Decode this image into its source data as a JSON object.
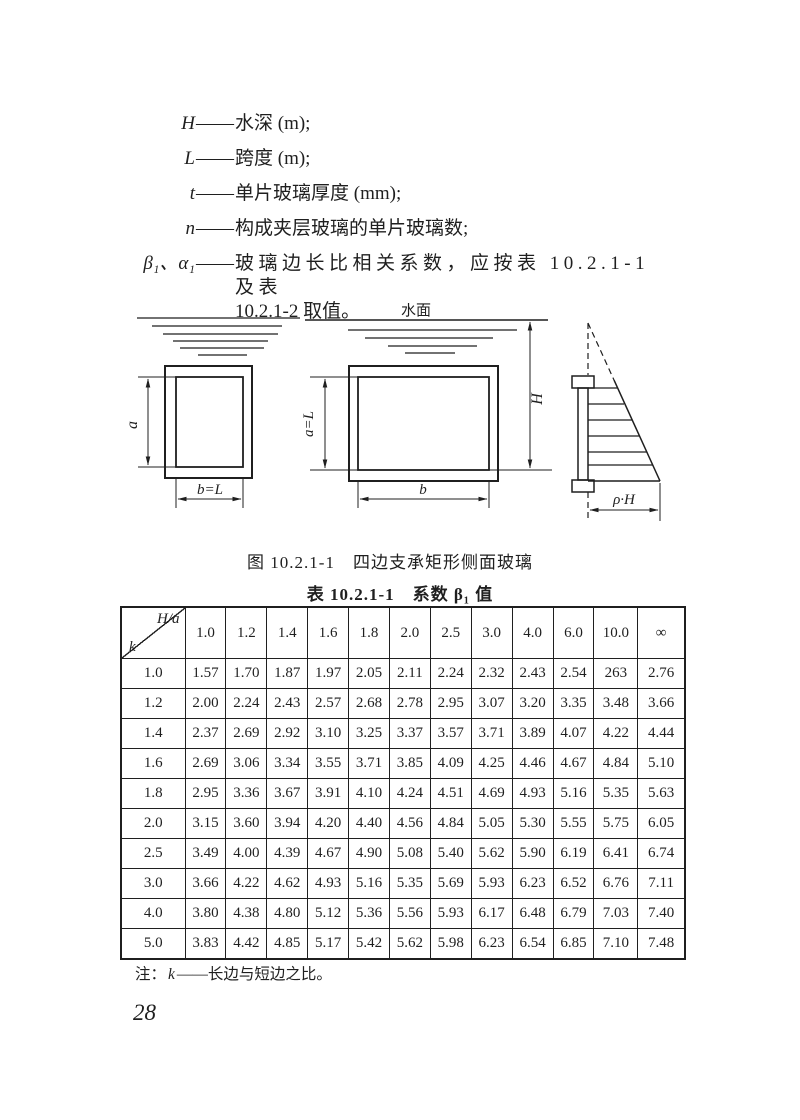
{
  "page": {
    "number": "28",
    "ink": "#1f1f1f",
    "background": "#ffffff"
  },
  "definitions_dash": "——",
  "definitions": [
    {
      "symbol": "H",
      "text": "水深 (m);"
    },
    {
      "symbol": "L",
      "text": "跨度 (m);"
    },
    {
      "symbol": "t",
      "text": "单片玻璃厚度 (mm);"
    },
    {
      "symbol": "n",
      "text": "构成夹层玻璃的单片玻璃数;"
    },
    {
      "symbol": "β₁、α₁",
      "text": "玻璃边长比相关系数，应按表 10.2.1-1 及表",
      "text2": "10.2.1-2 取值。",
      "spread": true
    }
  ],
  "figure": {
    "caption": "图 10.2.1-1　四边支承矩形侧面玻璃",
    "labels": {
      "water_surface": "水面",
      "a": "a",
      "b_eq_L": "b=L",
      "a_eq_L": "a=L",
      "b": "b",
      "H": "H",
      "rho_H": "ρ·H"
    }
  },
  "table": {
    "title": "表 10.2.1-1　系数 β₁ 值",
    "corner_top": "H/a",
    "corner_bottom": "k",
    "columns": [
      "1.0",
      "1.2",
      "1.4",
      "1.6",
      "1.8",
      "2.0",
      "2.5",
      "3.0",
      "4.0",
      "6.0",
      "10.0",
      "∞"
    ],
    "rows": [
      {
        "k": "1.0",
        "values": [
          "1.57",
          "1.70",
          "1.87",
          "1.97",
          "2.05",
          "2.11",
          "2.24",
          "2.32",
          "2.43",
          "2.54",
          "263",
          "2.76"
        ]
      },
      {
        "k": "1.2",
        "values": [
          "2.00",
          "2.24",
          "2.43",
          "2.57",
          "2.68",
          "2.78",
          "2.95",
          "3.07",
          "3.20",
          "3.35",
          "3.48",
          "3.66"
        ]
      },
      {
        "k": "1.4",
        "values": [
          "2.37",
          "2.69",
          "2.92",
          "3.10",
          "3.25",
          "3.37",
          "3.57",
          "3.71",
          "3.89",
          "4.07",
          "4.22",
          "4.44"
        ]
      },
      {
        "k": "1.6",
        "values": [
          "2.69",
          "3.06",
          "3.34",
          "3.55",
          "3.71",
          "3.85",
          "4.09",
          "4.25",
          "4.46",
          "4.67",
          "4.84",
          "5.10"
        ]
      },
      {
        "k": "1.8",
        "values": [
          "2.95",
          "3.36",
          "3.67",
          "3.91",
          "4.10",
          "4.24",
          "4.51",
          "4.69",
          "4.93",
          "5.16",
          "5.35",
          "5.63"
        ]
      },
      {
        "k": "2.0",
        "values": [
          "3.15",
          "3.60",
          "3.94",
          "4.20",
          "4.40",
          "4.56",
          "4.84",
          "5.05",
          "5.30",
          "5.55",
          "5.75",
          "6.05"
        ]
      },
      {
        "k": "2.5",
        "values": [
          "3.49",
          "4.00",
          "4.39",
          "4.67",
          "4.90",
          "5.08",
          "5.40",
          "5.62",
          "5.90",
          "6.19",
          "6.41",
          "6.74"
        ]
      },
      {
        "k": "3.0",
        "values": [
          "3.66",
          "4.22",
          "4.62",
          "4.93",
          "5.16",
          "5.35",
          "5.69",
          "5.93",
          "6.23",
          "6.52",
          "6.76",
          "7.11"
        ]
      },
      {
        "k": "4.0",
        "values": [
          "3.80",
          "4.38",
          "4.80",
          "5.12",
          "5.36",
          "5.56",
          "5.93",
          "6.17",
          "6.48",
          "6.79",
          "7.03",
          "7.40"
        ]
      },
      {
        "k": "5.0",
        "values": [
          "3.83",
          "4.42",
          "4.85",
          "5.17",
          "5.42",
          "5.62",
          "5.98",
          "6.23",
          "6.54",
          "6.85",
          "7.10",
          "7.48"
        ]
      }
    ]
  },
  "note": {
    "prefix": "注：",
    "symbol": "k",
    "text": "——长边与短边之比。"
  }
}
